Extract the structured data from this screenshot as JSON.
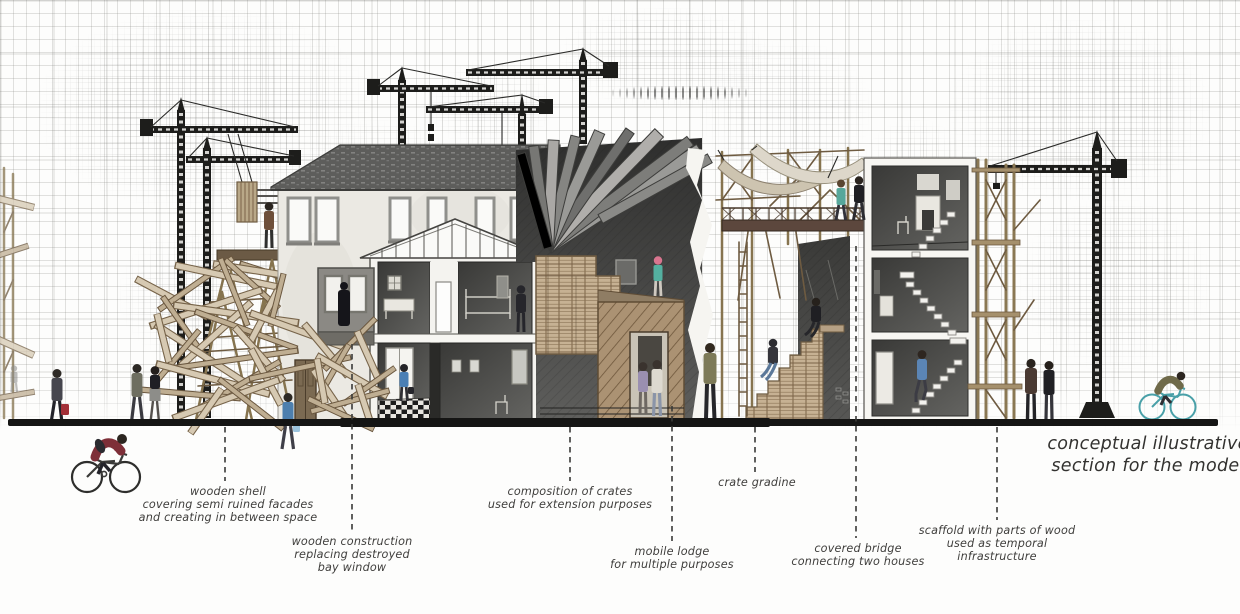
{
  "title": "conceptual illustrative\nsection for the model",
  "annotations": [
    {
      "id": "wooden-shell",
      "label": "wooden shell\ncovering semi ruined facades\nand creating in between space"
    },
    {
      "id": "wooden-construction",
      "label": "wooden construction\nreplacing destroyed\nbay window"
    },
    {
      "id": "composition-of-crates",
      "label": "composition of crates\nused for extension purposes"
    },
    {
      "id": "mobile-lodge",
      "label": "mobile lodge\nfor multiple purposes"
    },
    {
      "id": "crate-gradine",
      "label": "crate gradine"
    },
    {
      "id": "covered-bridge",
      "label": "covered bridge\nconnecting two houses"
    },
    {
      "id": "scaffold",
      "label": "scaffold with parts of wood\nused as temporal\ninfrastructure"
    }
  ],
  "colors": {
    "ink": "#1d1d1b",
    "ground": "#151514",
    "wood": "#8d7b5f",
    "crate": "#c6b193",
    "accent_blue": "#4a7fb5",
    "accent_red": "#a33038",
    "accent_teal": "#54b0a0",
    "accent_pink": "#d9758f",
    "canvas": "#fdfdfc"
  }
}
